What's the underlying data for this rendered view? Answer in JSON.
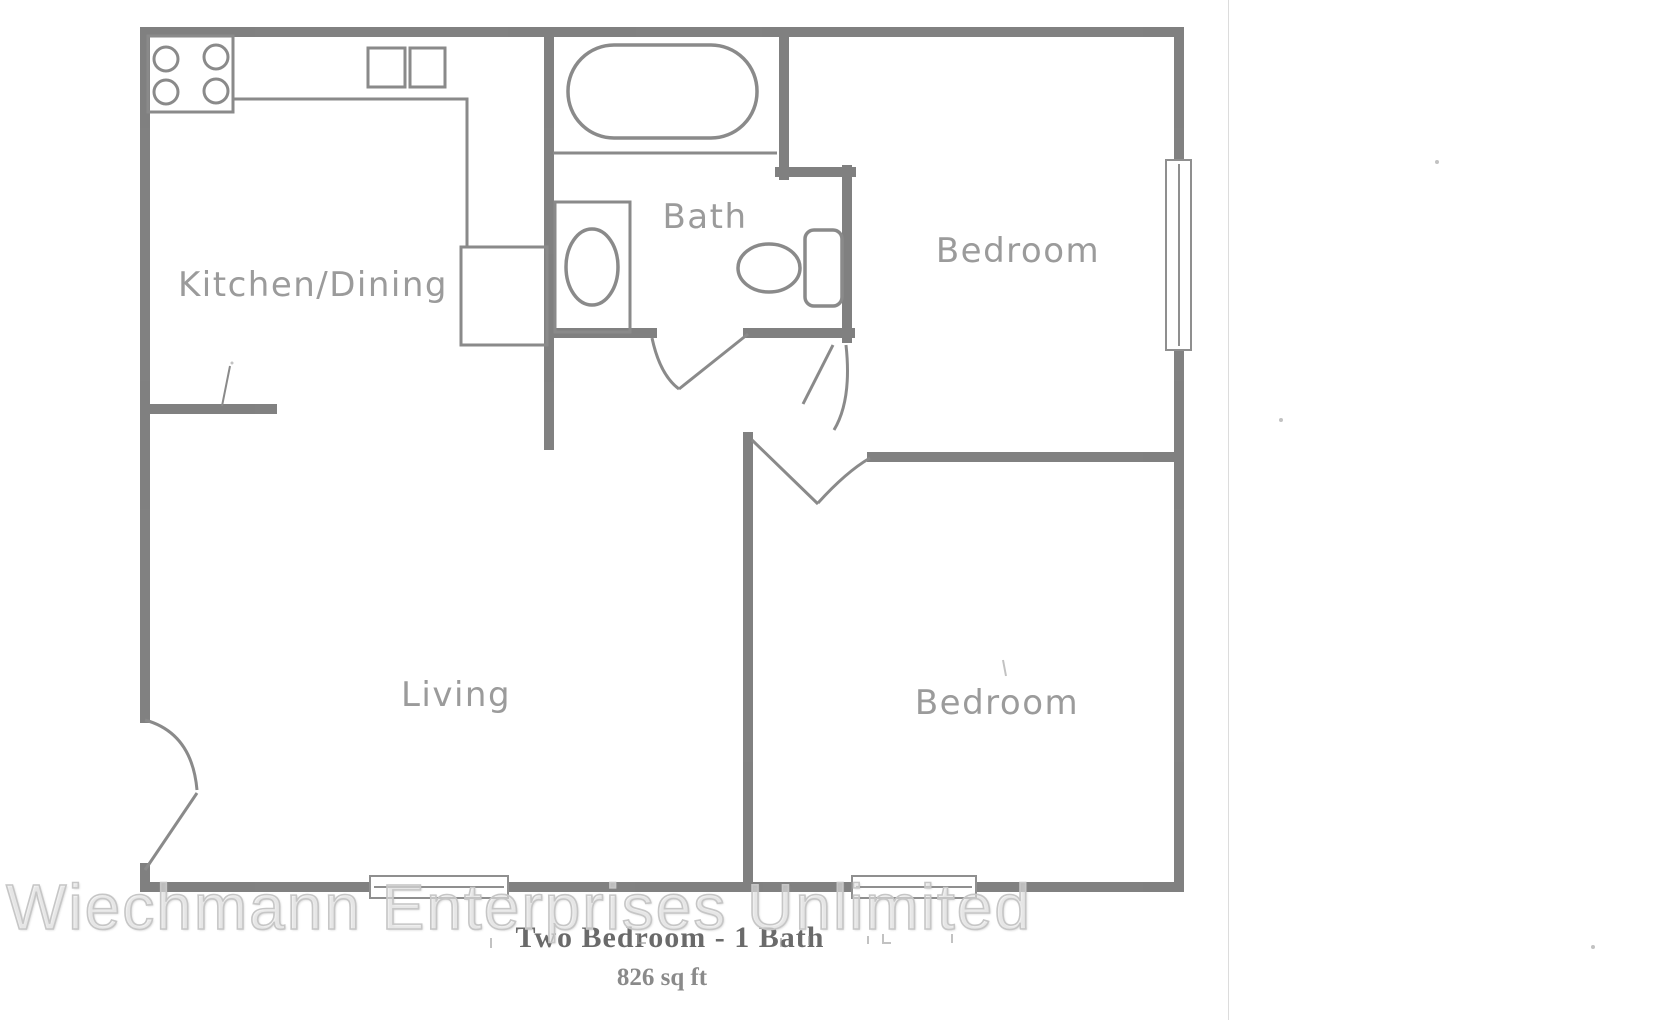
{
  "floor_plan": {
    "rooms": [
      {
        "label": "Kitchen/Dining"
      },
      {
        "label": "Bath"
      },
      {
        "label": "Bedroom"
      },
      {
        "label": "Living"
      },
      {
        "label": "Bedroom"
      }
    ],
    "fixtures": [
      "stove-burners",
      "kitchen-sink",
      "refrigerator",
      "bathtub",
      "vanity-sink",
      "toilet"
    ],
    "doors": [
      "entry-door",
      "bath-door",
      "bedroom-1-door",
      "bedroom-2-door"
    ],
    "window_count": 3
  },
  "caption": {
    "title": "Two Bedroom - 1 Bath",
    "area": "826 sq ft"
  },
  "watermark": {
    "text": "Wiechmann Enterprises Unlimited"
  },
  "colors": {
    "wall": "#7a7a7a",
    "thin_line": "#8a8a8a",
    "room_label": "#9b9b9b",
    "caption_text": "#6a6a6a",
    "watermark_text": "#c6c6c6",
    "background": "#ffffff"
  }
}
